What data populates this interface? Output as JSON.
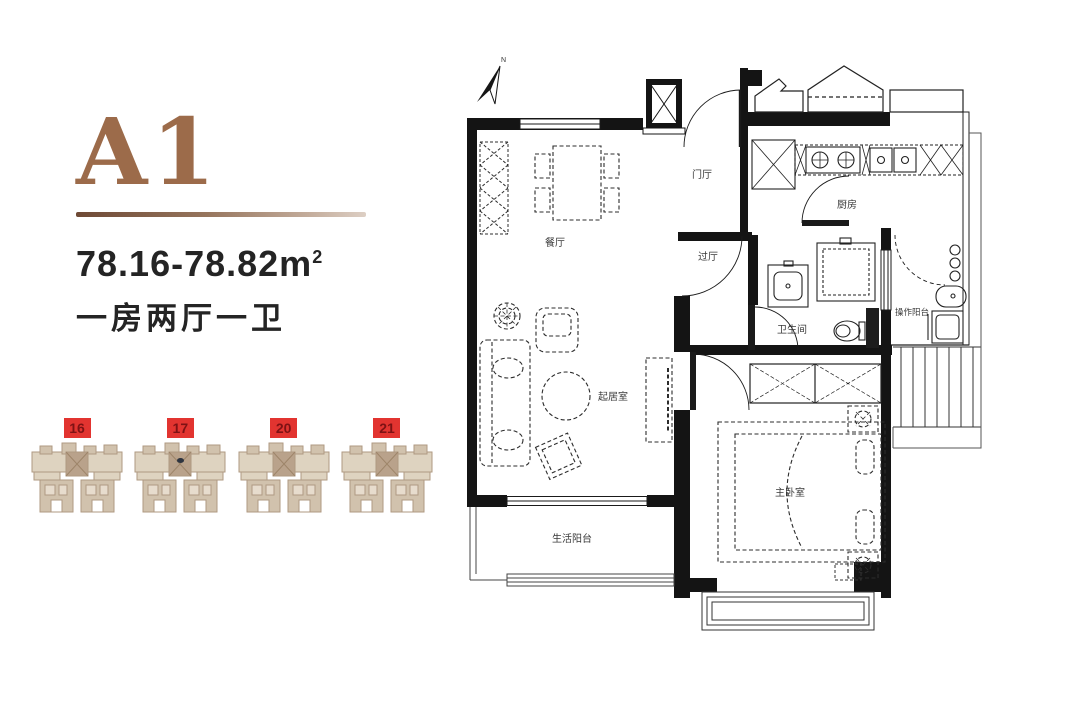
{
  "unit": {
    "name": "A1",
    "area_range": "78.16-78.82",
    "area_unit": "m",
    "area_sup": "2",
    "layout": "一房两厅一卫"
  },
  "site_plan": {
    "buildings": [
      {
        "number": "16",
        "marked": false
      },
      {
        "number": "17",
        "marked": true
      },
      {
        "number": "20",
        "marked": false
      },
      {
        "number": "21",
        "marked": false
      }
    ]
  },
  "floor_plan": {
    "compass_label": "N",
    "rooms": {
      "dining": "餐厅",
      "foyer": "门厅",
      "kitchen": "厨房",
      "hallway": "过厅",
      "bathroom": "卫生间",
      "utility_balcony": "操作阳台",
      "living": "起居室",
      "master_bedroom": "主卧室",
      "life_balcony": "生活阳台"
    }
  },
  "colors": {
    "accent_brown": "#9c6b4a",
    "marker_red": "#e23430",
    "marker_number": "#7e1214",
    "wall_black": "#141414",
    "building_tan": "#cfbfa9"
  }
}
